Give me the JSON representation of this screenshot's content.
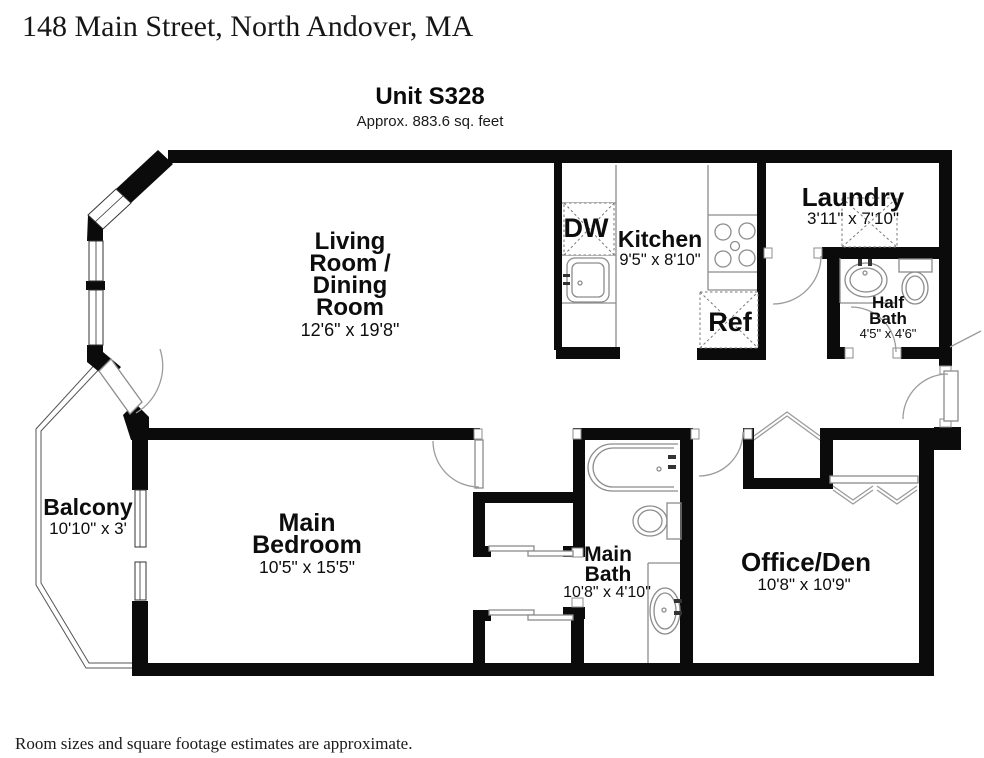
{
  "header": {
    "address": "148 Main Street, North Andover, MA",
    "unit_title": "Unit S328",
    "unit_area": "Approx. 883.6 sq. feet"
  },
  "footer": {
    "disclaimer": "Room sizes and square footage estimates are approximate."
  },
  "rooms": {
    "living_dining": {
      "lines": [
        "Living",
        "Room /",
        "Dining",
        "Room"
      ],
      "dims": "12'6\" x 19'8\""
    },
    "kitchen": {
      "name": "Kitchen",
      "dims": "9'5\" x 8'10\""
    },
    "laundry": {
      "name": "Laundry",
      "dims": "3'11\" x 7'10\""
    },
    "half_bath": {
      "lines": [
        "Half",
        "Bath"
      ],
      "dims": "4'5\" x 4'6\""
    },
    "balcony": {
      "name": "Balcony",
      "dims": "10'10\" x 3'"
    },
    "main_bedroom": {
      "lines": [
        "Main",
        "Bedroom"
      ],
      "dims": "10'5\" x 15'5\""
    },
    "main_bath": {
      "lines": [
        "Main",
        "Bath"
      ],
      "dims": "10'8\" x 4'10\""
    },
    "office_den": {
      "name": "Office/Den",
      "dims": "10'8\" x 10'9\""
    }
  },
  "appliances": {
    "dishwasher": "DW",
    "refrigerator": "Ref"
  },
  "colors": {
    "wall": "#0b0b0b",
    "fixture_line": "#8c8c8c",
    "text": "#0d0d0d"
  }
}
